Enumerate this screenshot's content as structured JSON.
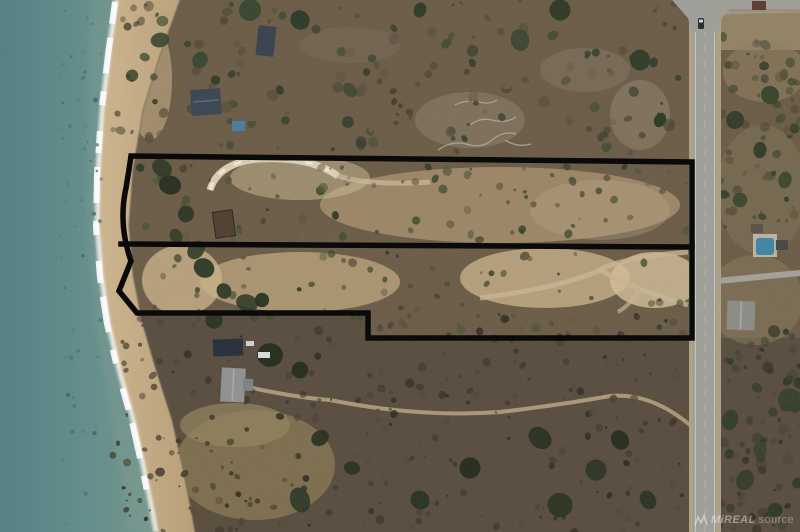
{
  "page": {
    "title": "Aerial lakefront property photo",
    "width": 800,
    "height": 532
  },
  "watermark": {
    "text_bold": "MiREAL",
    "text_light": "source"
  },
  "colors": {
    "water": "#5f8b8c",
    "surf": "#ffffff",
    "sand": "#c6ad85",
    "scrub": "#6b5c48",
    "south_brush": "#594d3f",
    "road": "#9f9f9a",
    "boundary": "#0a0a0a",
    "watermark": "rgba(255,255,255,0.42)"
  },
  "boundary": {
    "parcels_outlined": 2,
    "stroke_width": 5.5,
    "color": "#0a0a0a",
    "outer_path": "M131,156 L692,162 L692,338 L368,338 L368,313 L137,313 L119,291 L131,261 Q118,224 126,188 Q129,170 131,156 Z",
    "divider_path": "M121,244 L692,247"
  }
}
